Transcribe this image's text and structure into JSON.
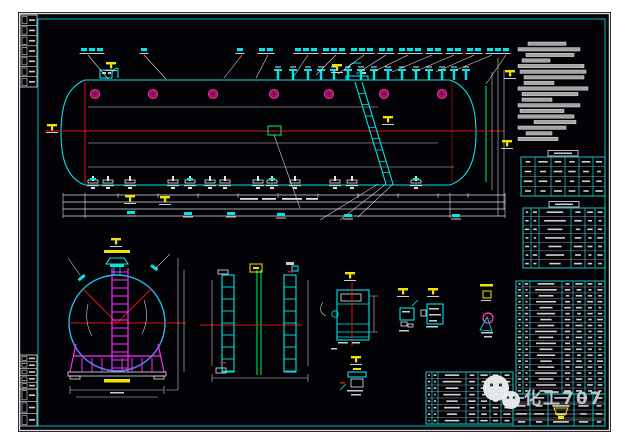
{
  "watermark": {
    "text": "化工707",
    "icon": "wechat-icon"
  },
  "colors": {
    "canvas_bg": "#020207",
    "frame_white": "#dcdcdc",
    "frame_cyan": "#00a8a8",
    "cyan": "#00e6e6",
    "red": "#d81414",
    "green": "#00c244",
    "magenta": "#ff2bff",
    "manhole_pink": "#a50d66",
    "yellow": "#f0e400",
    "white_line": "#e6e6e6",
    "note_bar": "#a3a3a3",
    "watermark_gray": "#c9ced3"
  },
  "main_view": {
    "manholes_x": [
      77,
      135,
      195,
      256,
      311,
      366,
      424
    ],
    "nozzles_x": [
      260,
      275,
      290,
      303,
      316,
      330,
      343,
      356,
      370,
      384,
      398,
      411,
      424,
      436,
      448
    ],
    "label_ticks_x": [
      66,
      74,
      82,
      126,
      222,
      244,
      252,
      280,
      288,
      296,
      308,
      316,
      324,
      336,
      344,
      352,
      364,
      372,
      384,
      392,
      400,
      412,
      420,
      432,
      440,
      452,
      460,
      472,
      480,
      488
    ],
    "leaders": [
      [
        70,
        43,
        90,
        67
      ],
      [
        126,
        43,
        148,
        67
      ],
      [
        224,
        43,
        206,
        66
      ],
      [
        250,
        43,
        238,
        66
      ],
      [
        290,
        43,
        276,
        64
      ],
      [
        318,
        43,
        298,
        63
      ],
      [
        346,
        43,
        320,
        62
      ],
      [
        368,
        43,
        338,
        62
      ],
      [
        390,
        43,
        355,
        60
      ],
      [
        414,
        43,
        374,
        60
      ],
      [
        436,
        43,
        396,
        60
      ],
      [
        456,
        43,
        418,
        60
      ],
      [
        474,
        43,
        438,
        58
      ],
      [
        488,
        43,
        468,
        72
      ]
    ],
    "bottom_fittings_x": [
      75,
      90,
      112,
      155,
      172,
      192,
      207,
      240,
      254,
      277,
      317,
      334,
      398
    ],
    "dim_rows_y": [
      183,
      190,
      197,
      204
    ],
    "dim_ticks_x": [
      45,
      67,
      100,
      140,
      180,
      220,
      260,
      300,
      340,
      380,
      420,
      432,
      450,
      487
    ],
    "dim_labels": [
      [
        113,
        199
      ],
      [
        170,
        200
      ],
      [
        213,
        200
      ],
      [
        263,
        201
      ],
      [
        330,
        202
      ],
      [
        438,
        202
      ]
    ],
    "dim_text_dashes": [
      [
        222,
        186,
        18
      ],
      [
        244,
        186,
        14
      ],
      [
        264,
        186,
        20
      ],
      [
        288,
        186,
        12
      ]
    ]
  },
  "yellow_markers": [
    [
      29,
      112
    ],
    [
      88,
      50
    ],
    [
      314,
      52
    ],
    [
      365,
      104
    ],
    [
      107,
      183
    ],
    [
      142,
      184
    ],
    [
      487,
      58
    ],
    [
      484,
      128
    ],
    [
      93,
      226
    ],
    [
      327,
      260
    ],
    [
      380,
      276
    ],
    [
      410,
      276
    ],
    [
      333,
      344
    ]
  ],
  "notes": {
    "x": 500,
    "y0": 30,
    "step": 5.6,
    "bar_h": 3.4,
    "bars": [
      [
        10,
        38
      ],
      [
        0,
        62
      ],
      [
        8,
        48
      ],
      [
        4,
        28
      ],
      [
        0,
        66
      ],
      [
        2,
        66
      ],
      [
        6,
        60
      ],
      [
        6,
        30
      ],
      [
        0,
        70
      ],
      [
        4,
        56
      ],
      [
        4,
        30
      ],
      [
        0,
        62
      ],
      [
        2,
        44
      ],
      [
        0,
        56
      ],
      [
        16,
        42
      ],
      [
        0,
        48
      ],
      [
        8,
        26
      ],
      [
        0,
        40
      ]
    ]
  },
  "tables": [
    {
      "name": "right-table-1",
      "x": 503,
      "y": 145,
      "w": 84,
      "h": 39,
      "rows": 4,
      "cols": [
        0,
        14,
        30,
        44,
        58,
        72,
        84
      ],
      "tab": true
    },
    {
      "name": "right-table-2",
      "x": 505,
      "y": 196,
      "w": 82,
      "h": 60,
      "rows": 7,
      "cols": [
        0,
        8,
        16,
        48,
        62,
        72,
        82
      ],
      "tab": true
    },
    {
      "name": "bom-table",
      "x": 498,
      "y": 269,
      "w": 89,
      "h": 113,
      "rows": 19,
      "cols": [
        0,
        7,
        14,
        46,
        57,
        69,
        79,
        89
      ],
      "tab": false
    },
    {
      "name": "parts-table",
      "x": 408,
      "y": 360,
      "w": 87,
      "h": 52,
      "rows": 8,
      "cols": [
        0,
        6,
        12,
        40,
        52,
        64,
        75,
        87
      ],
      "tab": false
    },
    {
      "name": "title-block-grid",
      "x": 495,
      "y": 382,
      "w": 92,
      "h": 32,
      "rows": 4,
      "cols": [
        0,
        17,
        35,
        61,
        80,
        92
      ],
      "tab": false
    }
  ],
  "left_strips": [
    {
      "name": "revision-strip-top",
      "x": 2,
      "y": 3,
      "w": 17,
      "h": 72,
      "rows": 7
    },
    {
      "name": "revision-strip-bottom-1",
      "x": 2,
      "y": 343,
      "w": 17,
      "h": 34,
      "rows": 5
    },
    {
      "name": "revision-strip-bottom-2",
      "x": 2,
      "y": 377,
      "w": 17,
      "h": 37,
      "rows": 3
    }
  ]
}
